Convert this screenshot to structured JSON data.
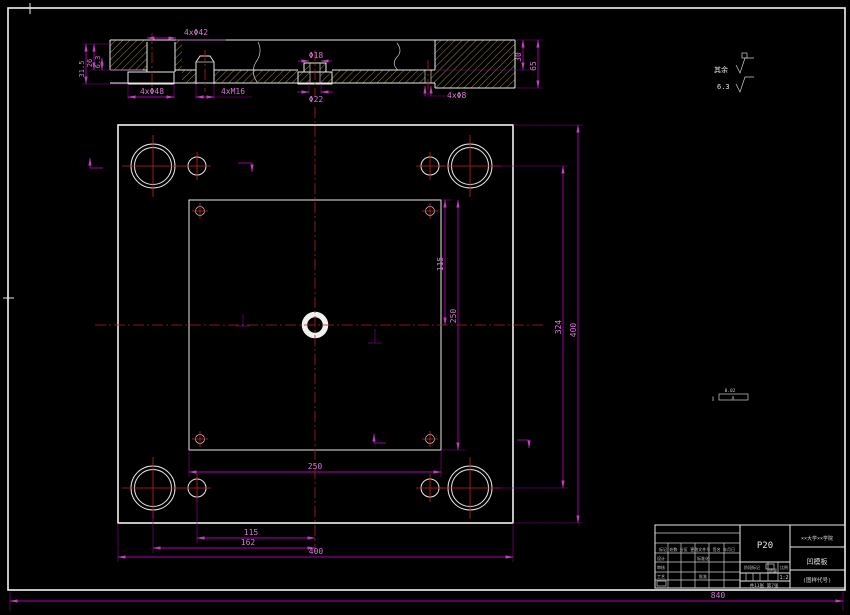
{
  "sheet": {
    "overall_width_dim": "840"
  },
  "surface_note": {
    "label": "其余",
    "value": "6.3"
  },
  "gdt_note": {
    "symbol": "∥",
    "value": "0.02",
    "datum": "A"
  },
  "section_view": {
    "dims": {
      "counterbore_top": "4xΦ42",
      "counterbore_bottom": "4xΦ48",
      "screw_holes": "4xM16",
      "center_hole_top": "Φ18",
      "center_hole_bottom": "Φ22",
      "small_holes": "4xΦ8",
      "step_depth": "30",
      "thickness": "65",
      "left_depth_total": "31.5",
      "left_depth_bore": "26",
      "left_depth_step": "6.3"
    }
  },
  "plan_view": {
    "dims": {
      "pocket_width": "250",
      "pocket_height": "250",
      "hole_offset_vertical": "115",
      "guide_hole_span": "324",
      "plate_height": "400",
      "hole_offset_horizontal": "115",
      "guide_hole_offset": "162",
      "plate_width": "400"
    }
  },
  "title_block": {
    "material": "P20",
    "company": "××大学××学院",
    "part_name": "凹模板",
    "drawing_code": "(图样代号)",
    "stage_label": "阶段标记",
    "weight_label": "质量",
    "scale_label": "比例",
    "scale_value": "1:2",
    "sheet_note": "共11张 第7张",
    "header_row": "标记 处数 分区 更改文件号 签名 年月日",
    "role_design": "设计",
    "role_check": "审核",
    "role_process": "工艺",
    "role_standard": "标准化",
    "role_approve": "批准"
  }
}
